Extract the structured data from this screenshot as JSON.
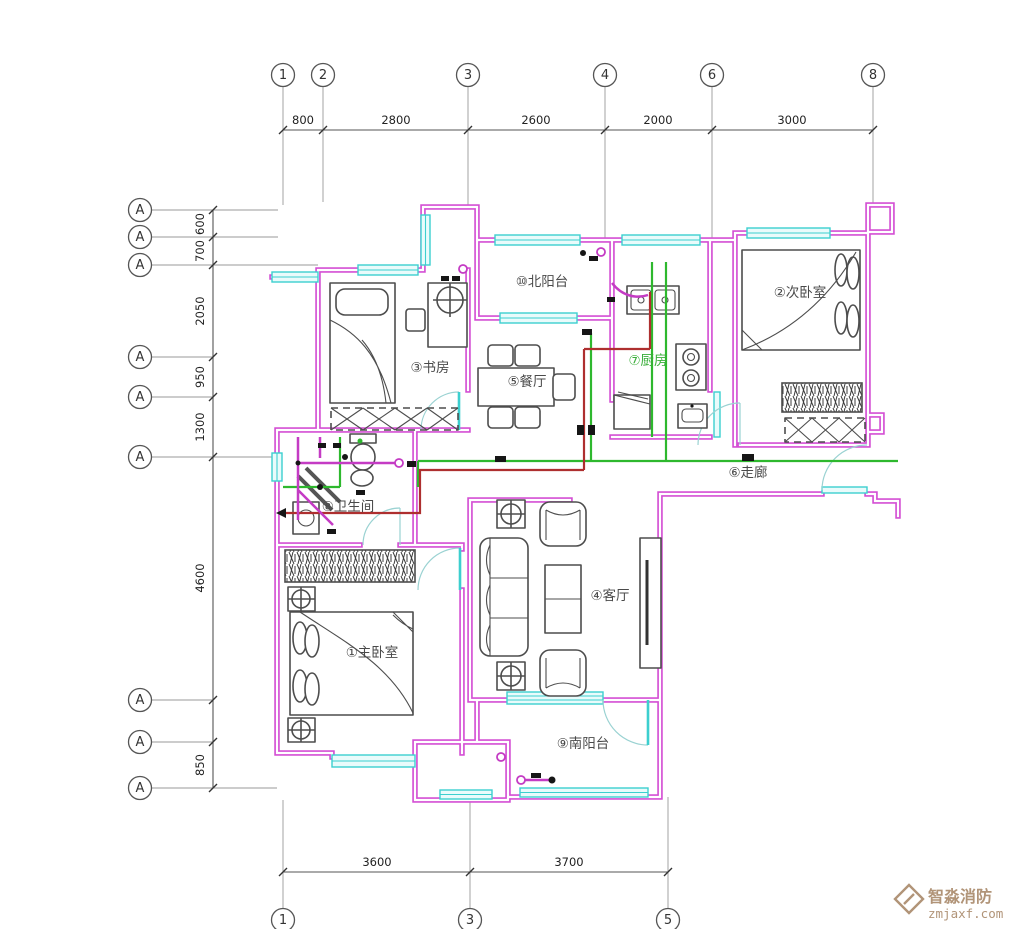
{
  "colors": {
    "wall": "#d44fd4",
    "window": "#3ccfcf",
    "wire_green": "#2eb82e",
    "wire_red": "#ae2f2f",
    "wire_magenta": "#c43bc4",
    "furniture": "#4d4d4d",
    "room_text": "#4a4a4a",
    "kitchen_label": "#3aae3a",
    "watermark": "#b19478"
  },
  "grid": {
    "top_bubbles": [
      {
        "label": "1"
      },
      {
        "label": "2"
      },
      {
        "label": "3"
      },
      {
        "label": "4"
      },
      {
        "label": "6"
      },
      {
        "label": "8"
      }
    ],
    "top_dims": [
      "800",
      "2800",
      "2600",
      "2000",
      "3000"
    ],
    "left_bubbles": [
      {
        "label": "A"
      },
      {
        "label": "A"
      },
      {
        "label": "A"
      },
      {
        "label": "A"
      },
      {
        "label": "A"
      },
      {
        "label": "A"
      },
      {
        "label": "A"
      },
      {
        "label": "A"
      },
      {
        "label": "A"
      }
    ],
    "left_dims": [
      "600",
      "700",
      "2050",
      "950",
      "1300",
      "4600",
      "850"
    ],
    "bottom_bubbles": [
      {
        "label": "1"
      },
      {
        "label": "3"
      },
      {
        "label": "5"
      }
    ],
    "bottom_dims": [
      "3600",
      "3700"
    ]
  },
  "rooms": {
    "master_bedroom": "①主卧室",
    "second_bedroom": "②次卧室",
    "study": "③书房",
    "living_room": "④客厅",
    "dining_room": "⑤餐厅",
    "corridor": "⑥走廊",
    "kitchen": "⑦厨房",
    "bathroom": "⑧卫生间",
    "south_balcony": "⑨南阳台",
    "north_balcony": "⑩北阳台"
  },
  "watermark": {
    "brand": "智淼消防",
    "site": "zmjaxf.com"
  }
}
